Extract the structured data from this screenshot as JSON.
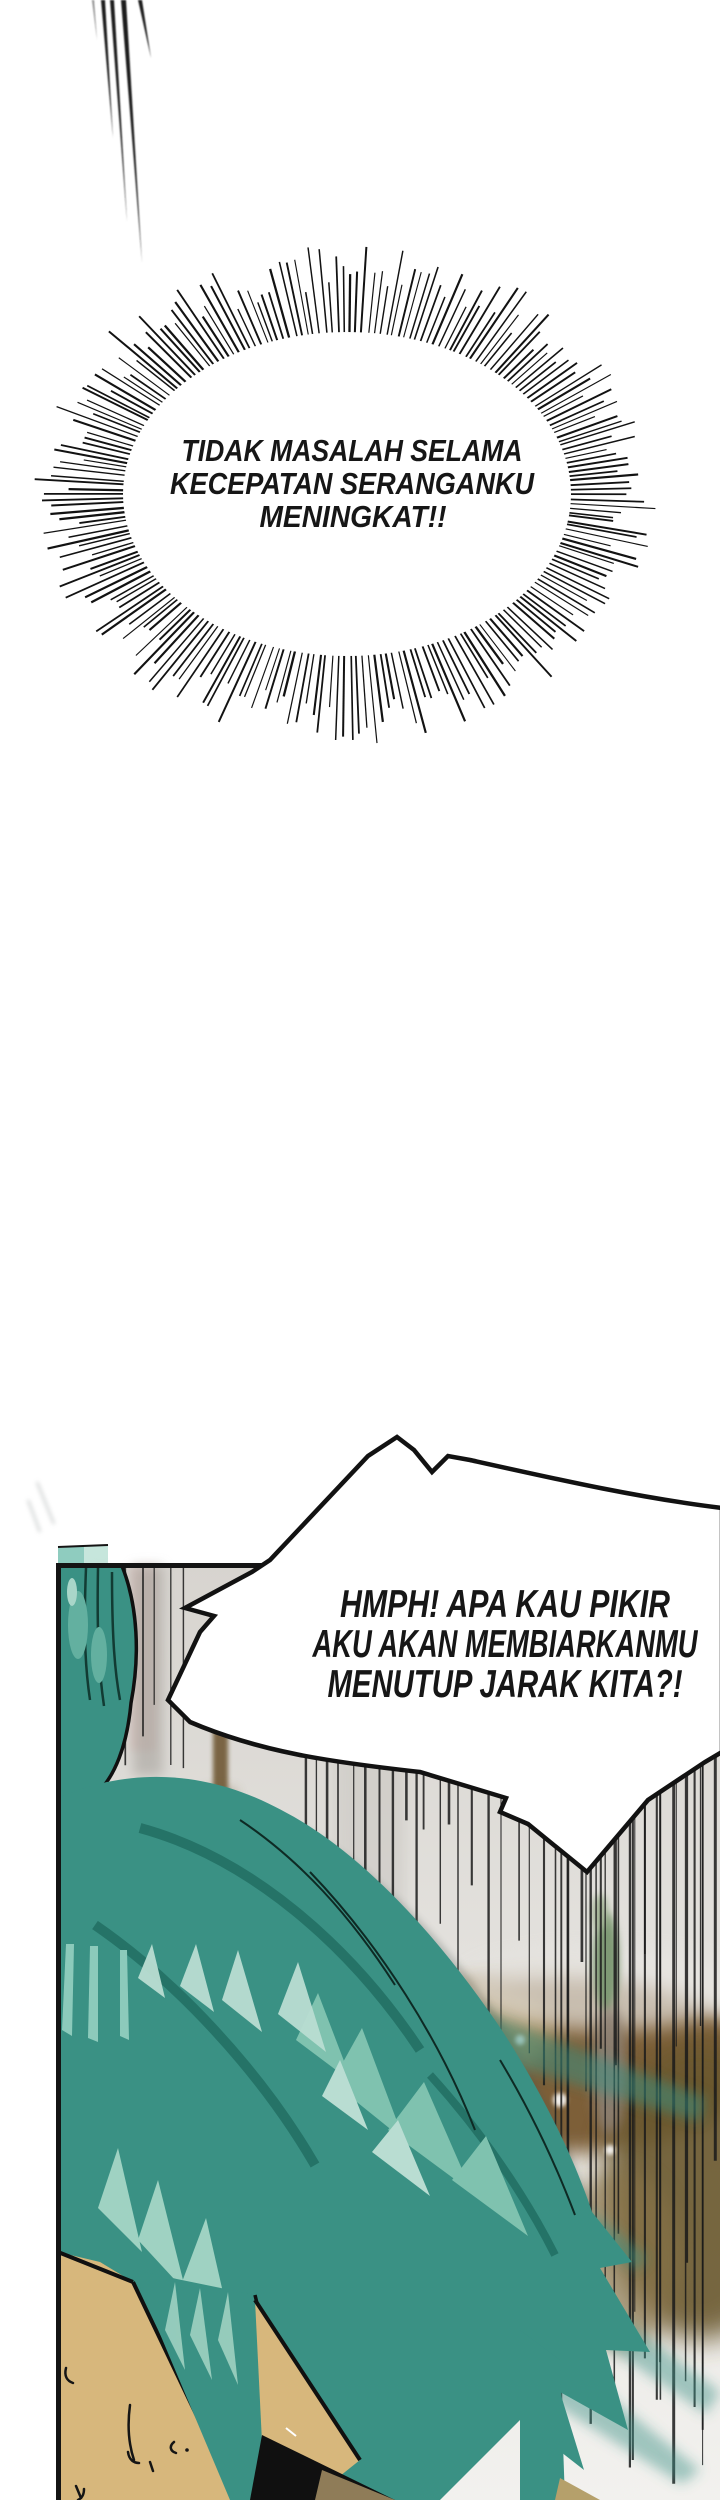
{
  "page": {
    "background": "#ffffff"
  },
  "bubbles": {
    "burst": {
      "lines": [
        "TIDAK MASALAH SELAMA",
        "KECEPATAN SERANGANKU",
        "MENINGKAT!!"
      ]
    },
    "shout": {
      "lines": [
        "HMPH! APA KAU PIKIR",
        "AKU AKAN MEMBIARKANMU",
        "MENUTUP JARAK KITA?!"
      ]
    }
  },
  "colors": {
    "ink": "#141414",
    "hair_teal": "#3a9184",
    "hair_teal_dark": "#1e6a5e",
    "hair_teal_light": "#7fc2af",
    "hair_teal_pale": "#b9ddd2",
    "skin": "#d7b77c",
    "panel_bg_top": "#d7d4cf",
    "panel_bg_bottom": "#f2f1ee",
    "ground_brown": "#7d5f38",
    "black_patch": "#101010",
    "khaki": "#8f7c58"
  }
}
